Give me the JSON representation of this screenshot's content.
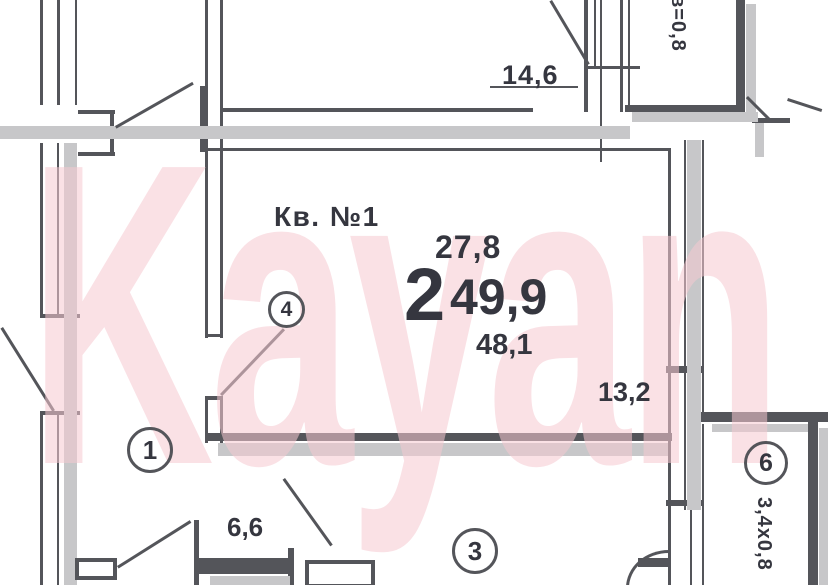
{
  "watermark": {
    "text": "Kayan"
  },
  "plan": {
    "apartment_label": "Кв. №1",
    "room_count": "2",
    "living_area": "27,8",
    "total_area": "49,9",
    "area_alt": "48,1",
    "dim_top_room": "14,6",
    "dim_main_room": "13,2",
    "dim_kitchen": "6,6",
    "balcony_top_label": "в=0,8",
    "balcony_right_label": "3,4х0,8",
    "markers": {
      "hall": "1",
      "room3": "3",
      "closet": "4",
      "balcony": "6"
    }
  },
  "colors": {
    "wall": "#54555a",
    "shadow": "#c7c7c9",
    "pink": "#f6c9d1",
    "text": "#35363f"
  }
}
